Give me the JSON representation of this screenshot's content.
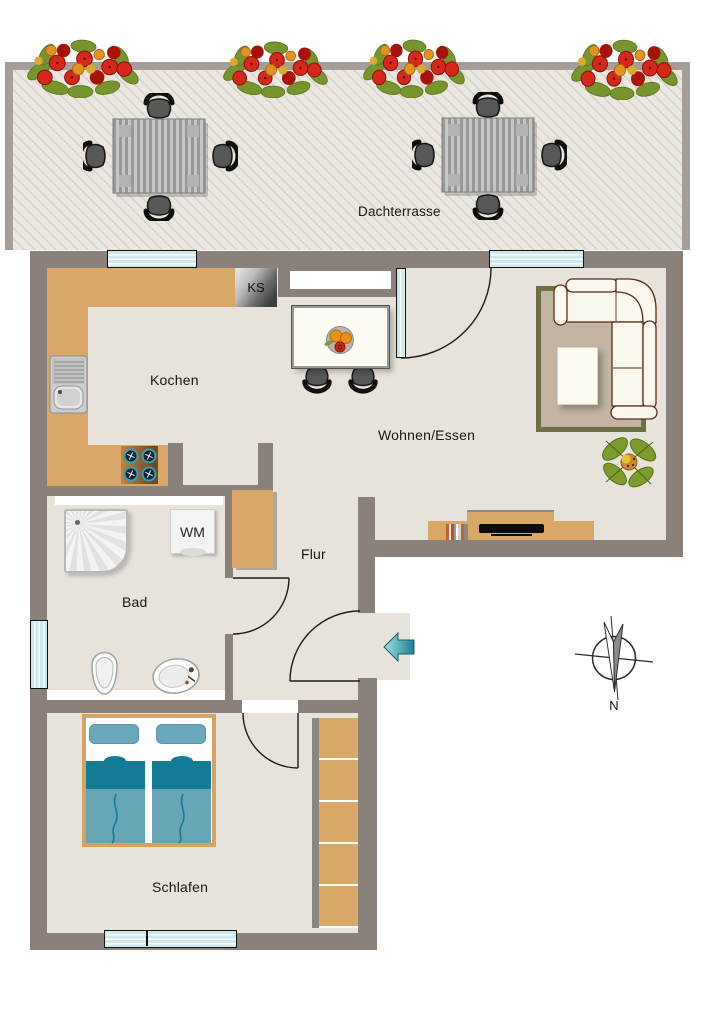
{
  "labels": {
    "terrace": "Dachterrasse",
    "kitchen": "Kochen",
    "living": "Wohnen/Essen",
    "hall": "Flur",
    "bath": "Bad",
    "bedroom": "Schlafen",
    "fridge": "KS",
    "washing_machine": "WM",
    "compass_north": "N"
  },
  "colors": {
    "wall": "#8b817b",
    "terrace_wall": "#a59d97",
    "floor": "#e7e3da",
    "terrace_floor": "#eae7e1",
    "hatch": "#d6d2c9",
    "counter": "#d9a768",
    "wood": "#d6a364",
    "glass": "#cfe8ec",
    "sofa": "#fbf8ee",
    "sofa_line": "#5e2c1c",
    "rug": "#c3b5a2",
    "rug_border": "#6e7044",
    "teal_dark": "#157c97",
    "teal_mid": "#66a6b5",
    "teal_pillow": "#68a8ba",
    "arrow_teal": "#2b8ca0",
    "label": "#161616"
  }
}
